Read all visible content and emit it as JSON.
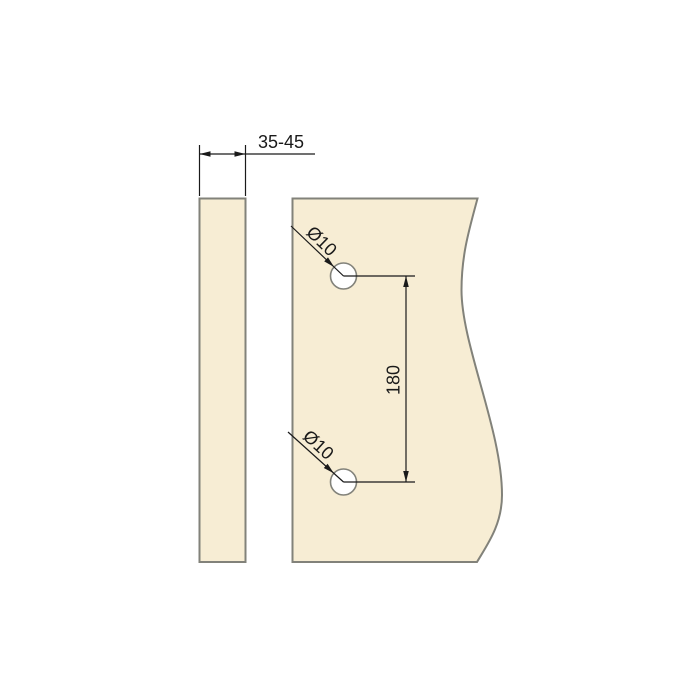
{
  "diagram": {
    "type": "technical-drawing",
    "labels": {
      "thickness": "35-45",
      "hole_top": "Ø10",
      "hole_bottom": "Ø10",
      "hole_spacing": "180"
    },
    "colors": {
      "background": "#ffffff",
      "panel_fill": "#f7edd4",
      "panel_stroke": "#82827a",
      "dimension": "#1a1a1a",
      "hole_fill": "#ffffff"
    }
  }
}
